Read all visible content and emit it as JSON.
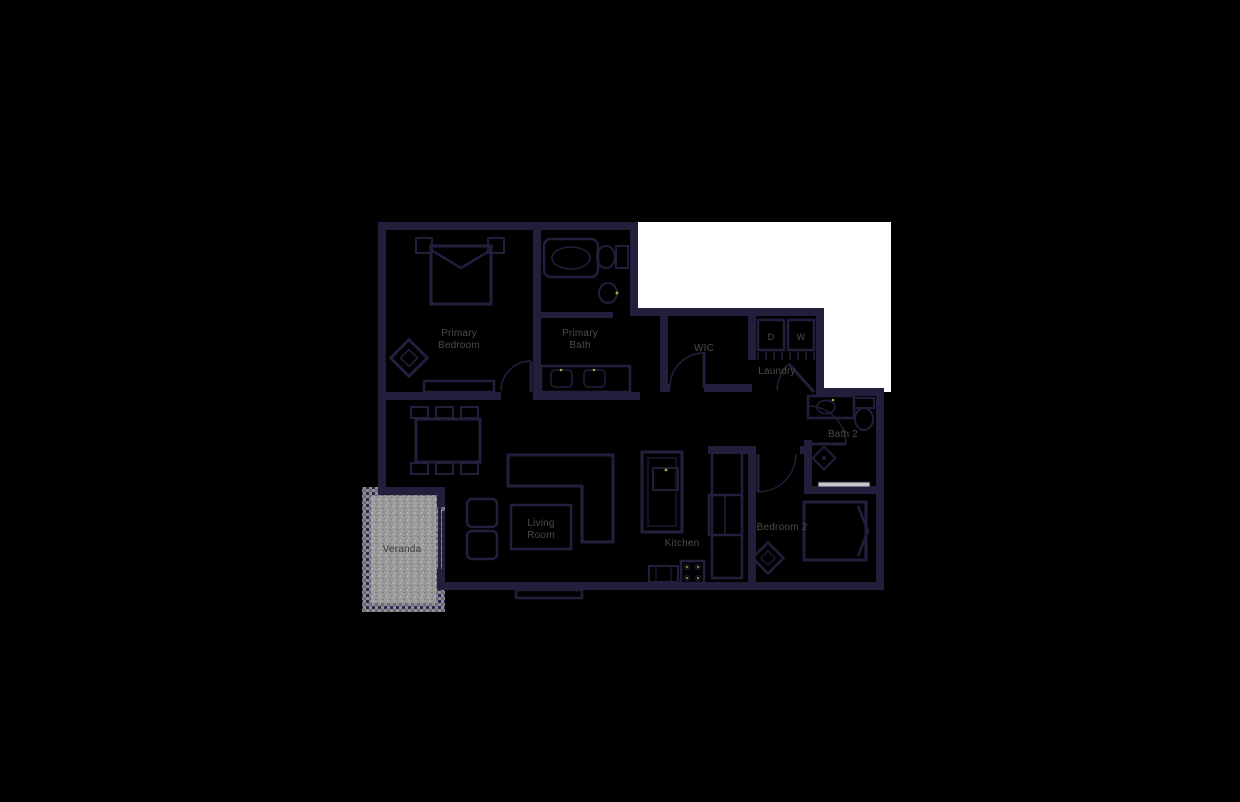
{
  "theme": {
    "background": "#000000",
    "wall": "#221f3d",
    "mask": "#ffffff",
    "label": "#4b4b47",
    "label_dark": "#3a3a36",
    "veranda_fill": "#9a9a9a",
    "veranda_speck_light": "#bfbfbf",
    "veranda_speck_dark": "#707070",
    "veranda_border_a": "#8e8e8e",
    "veranda_border_b": "#2b2850",
    "veranda_border_c": "#6b6b7e",
    "glass": "#c8c8c8",
    "accent": "#a8a83c"
  },
  "floorplan": {
    "rooms": {
      "primary_bedroom": {
        "line1": "Primary",
        "line2": "Bedroom"
      },
      "primary_bath": {
        "line1": "Primary",
        "line2": "Bath"
      },
      "wic": {
        "label": "WIC"
      },
      "laundry": {
        "label": "Laundry"
      },
      "bath2": {
        "label": "Bath 2"
      },
      "bedroom2": {
        "label": "Bedroom 2"
      },
      "kitchen": {
        "label": "Kitchen"
      },
      "living_room": {
        "line1": "Living",
        "line2": "Room"
      },
      "veranda": {
        "label": "Veranda"
      }
    },
    "appliances": {
      "dryer": "D",
      "washer": "W"
    }
  }
}
